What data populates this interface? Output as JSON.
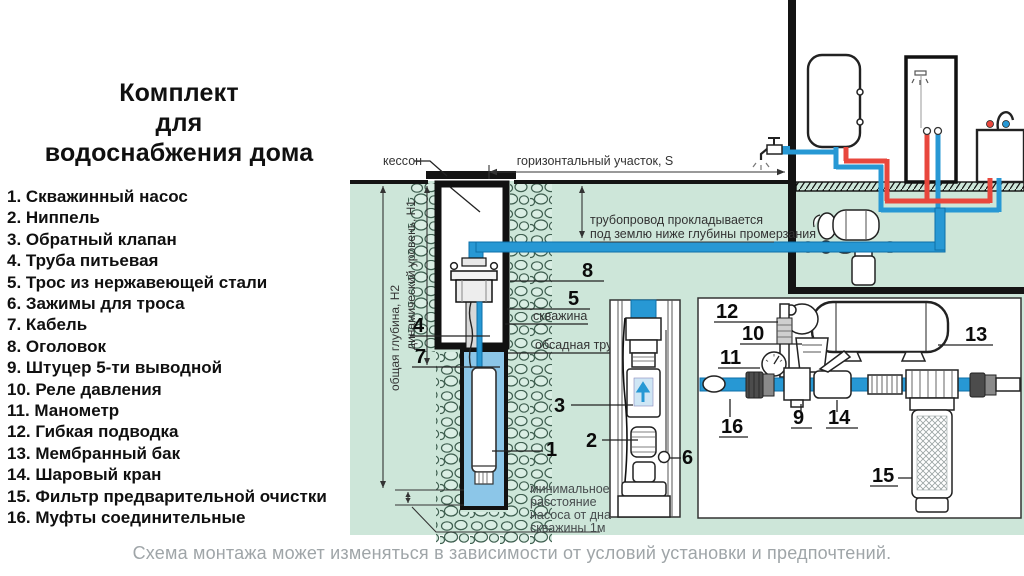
{
  "title": {
    "line1": "Комплект",
    "line2": "для",
    "line3": "водоснабжения дома"
  },
  "parts": [
    "1. Скважинный насос",
    "2. Ниппель",
    "3. Обратный клапан",
    "4. Труба питьевая",
    "5. Трос из нержавеющей стали",
    "6. Зажимы для троса",
    "7. Кабель",
    "8. Оголовок",
    "9. Штуцер 5-ти выводной",
    "10. Реле давления",
    "11. Манометр",
    "12. Гибкая подводка",
    "13. Мембранный бак",
    "14. Шаровый кран",
    "15. Фильтр предварительной очистки",
    "16. Муфты соединительные"
  ],
  "diagram": {
    "labels": {
      "caisson": "кессон",
      "horizontal_section": "горизонтальный участок, S",
      "pipeline_line1": "трубопровод прокладывается",
      "pipeline_line2": "под землю ниже глубины промерзания",
      "total_depth": "общая глубина, Н2",
      "dynamic_level": "динамический уровень, Н1",
      "borehole": "скважина",
      "casing_pipe": "обсадная труба",
      "min_dist_1": "минимальное",
      "min_dist_2": "расстояние",
      "min_dist_3": "насоса от дна",
      "min_dist_4": "скважины 1м"
    },
    "callouts": {
      "n1": "1",
      "n2": "2",
      "n3": "3",
      "n4": "4",
      "n5": "5",
      "n6": "6",
      "n7": "7",
      "n8": "8",
      "n9": "9",
      "n10": "10",
      "n11": "11",
      "n12": "12",
      "n13": "13",
      "n14": "14",
      "n15": "15",
      "n16": "16"
    }
  },
  "footer": {
    "note": "Схема монтажа может изменяться в зависимости от условий установки и предпочтений."
  },
  "colors": {
    "ground": "#cde6d9",
    "stone": "#3f5f50",
    "stone_fill": "#daeee4",
    "pipe_blue": "#2798d4",
    "pipe_blue_dark": "#0e6fa8",
    "pipe_red": "#e8473d",
    "water": "#8cc6e8",
    "note_gray": "#9fa5a8",
    "dim": "#474c4e"
  }
}
